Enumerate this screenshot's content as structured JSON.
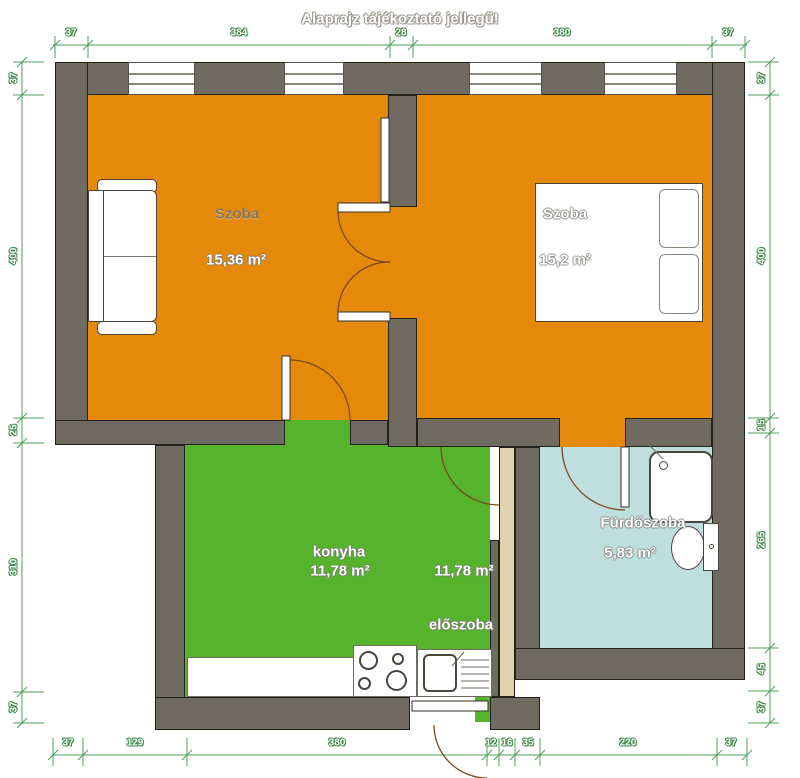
{
  "title": "Alaprajz tájékoztató jellegű!",
  "rooms": {
    "szoba1": {
      "name": "Szoba",
      "area": "15,36 m²"
    },
    "szoba2": {
      "name": "Szoba",
      "area": "15,2 m²"
    },
    "konyha": {
      "name": "konyha",
      "area": "11,78 m²"
    },
    "eloszoba": {
      "name": "előszoba",
      "area": "11,78 m²"
    },
    "furdoszoba": {
      "name": "Fürdőszoba",
      "area": "5,83 m²"
    }
  },
  "dimensions": {
    "top": [
      "37",
      "384",
      "28",
      "380",
      "37"
    ],
    "left": [
      "37",
      "400",
      "25",
      "310",
      "37"
    ],
    "right": [
      "37",
      "400",
      "15",
      "265",
      "45",
      "37"
    ],
    "bottom": [
      "37",
      "129",
      "380",
      "12",
      "16",
      "35",
      "220",
      "37"
    ]
  },
  "colors": {
    "room_fill": "#e5890a",
    "kitchen_fill": "#55b32c",
    "bathroom_fill": "#bfdede",
    "wall": "#6f6b60",
    "dimension_line": "#4f9f5d",
    "door_panel": "#ded3ae"
  },
  "furniture": {
    "sofa": "sofa",
    "bed": "double-bed",
    "pillows": "pillows",
    "shower": "shower-cabin",
    "toilet": "toilet",
    "counter": "kitchen-counter",
    "stove": "stove-four-burners",
    "sink": "kitchen-sink-with-drainboard",
    "doors": "door-swing-arcs"
  }
}
